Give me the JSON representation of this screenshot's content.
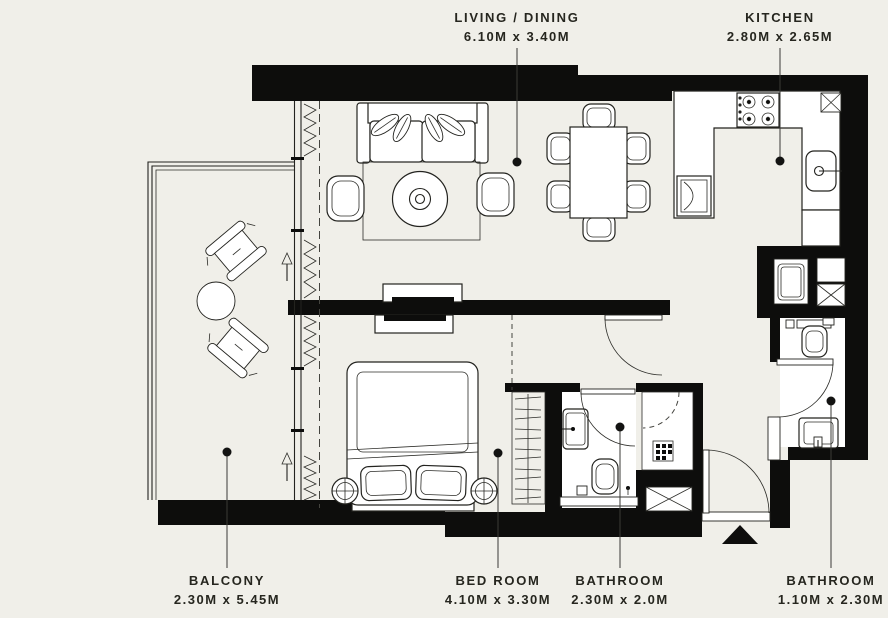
{
  "plan": {
    "colors": {
      "background": "#f0efe9",
      "walls": "#0d0d0c",
      "fixtures": "#ffffff",
      "text": "#26261f"
    },
    "rooms": [
      {
        "key": "living-dining",
        "name": "LIVING / DINING",
        "dims": "6.10M x 3.40M"
      },
      {
        "key": "kitchen",
        "name": "KITCHEN",
        "dims": "2.80M x 2.65M"
      },
      {
        "key": "balcony",
        "name": "BALCONY",
        "dims": "2.30M x 5.45M"
      },
      {
        "key": "bedroom",
        "name": "BED ROOM",
        "dims": "4.10M x 3.30M"
      },
      {
        "key": "bathroom-ensuite",
        "name": "BATHROOM",
        "dims": "2.30M x 2.0M"
      },
      {
        "key": "bathroom-guest",
        "name": "BATHROOM",
        "dims": "1.10M x 2.30M"
      }
    ],
    "symbols": [
      "sofa",
      "coffee-table",
      "armchair",
      "rug",
      "dining-table",
      "dining-chair",
      "stove",
      "kitchen-sink",
      "oven",
      "washing-machine",
      "service-shaft",
      "bed",
      "pillow",
      "bedside-table",
      "tv-console",
      "wardrobe-hangers",
      "toilet",
      "wash-basin",
      "shower",
      "door-swing",
      "entrance-marker",
      "balcony-chair",
      "balcony-table",
      "direction-arrow",
      "window-glazing"
    ]
  }
}
